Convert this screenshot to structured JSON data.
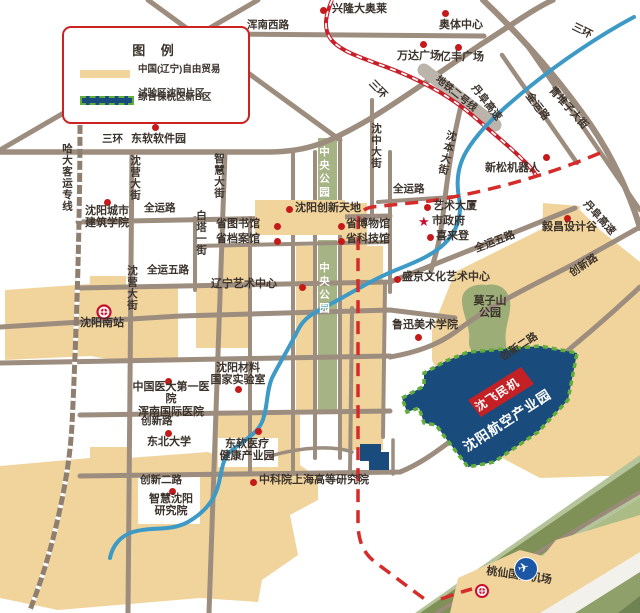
{
  "legend": {
    "title": "图 例",
    "item1_line1": "中国(辽宁)自由贸易",
    "item1_line2": "试验区沈阳片区",
    "item2": "综合保税区新B区"
  },
  "pois": {
    "xinglong": "兴隆大奥莱",
    "aoti": "奥体中心",
    "wanda": "万达广场",
    "yifeng": "亿丰广场",
    "xinsong": "新松机器人",
    "dongruan_software": "东软软件园",
    "chengshi": "沈阳城市\n建筑学院",
    "tiandi": "沈阳创新天地",
    "tushuguan": "省图书馆",
    "bowuguan": "省博物馆",
    "dangan": "省档案馆",
    "keji": "省科技馆",
    "liaoyi": "辽宁艺术中心",
    "yishudasha": "艺术大厦",
    "shizhengfu": "市政府",
    "xilaideng": "喜来登",
    "yichang": "毅昌设计谷",
    "shengjing": "盛京文化艺术中心",
    "luxun": "鲁迅美术学院",
    "cailiao": "沈阳材料\n国家实验室",
    "yida": "中国医大第一医院\n浑南国际医院",
    "dongbei": "东北大学",
    "dongruan_yiliao": "东软医疗\n健康产业园",
    "zhihui_yanjiuyuan": "智慧沈阳\n研究院",
    "zhongkeyuan": "中科院上海高等研究院"
  },
  "roads": {
    "hunnanxilu": "浑南西路",
    "jinyang": "金阳大街",
    "sanhuan": "三环",
    "quanyun": "全运路",
    "quanyunwu": "全运五路",
    "hada": "哈大客运专线",
    "shenying": "沈营大街",
    "zhihui": "智慧大街",
    "baita": "白塔一街",
    "shenzhong": "沈中大街",
    "ditie2": "地铁二号线",
    "danfu": "丹阜高速",
    "jinyun": "金运路",
    "qingduizi": "青堆子大街",
    "chuangxin": "创新路",
    "chuangxin2": "创新二路",
    "shenben": "沈本大街"
  },
  "parks": {
    "central": "中央公园",
    "mozishan": "莫子山\n公园"
  },
  "zones": {
    "shenfei": "沈飞民机",
    "aviation": "沈阳航空产业园"
  },
  "stations": {
    "south": "沈阳南站",
    "airport": "桃仙国际机场"
  },
  "icons": {
    "airport_plane": "✈",
    "city_hall_star": "★"
  },
  "colors": {
    "ftz_fill": "#F1D49B",
    "bonded_fill": "#1A4B7D",
    "bonded_border": "#62AE3C",
    "road": "#9D8D7F",
    "river": "#3D9AC6",
    "poi_dot": "#C41A1A",
    "rail_red": "#C8202A",
    "boundary_dash": "#D62B2B",
    "park_green": "#A5B385",
    "legend_border": "#CC2222"
  }
}
